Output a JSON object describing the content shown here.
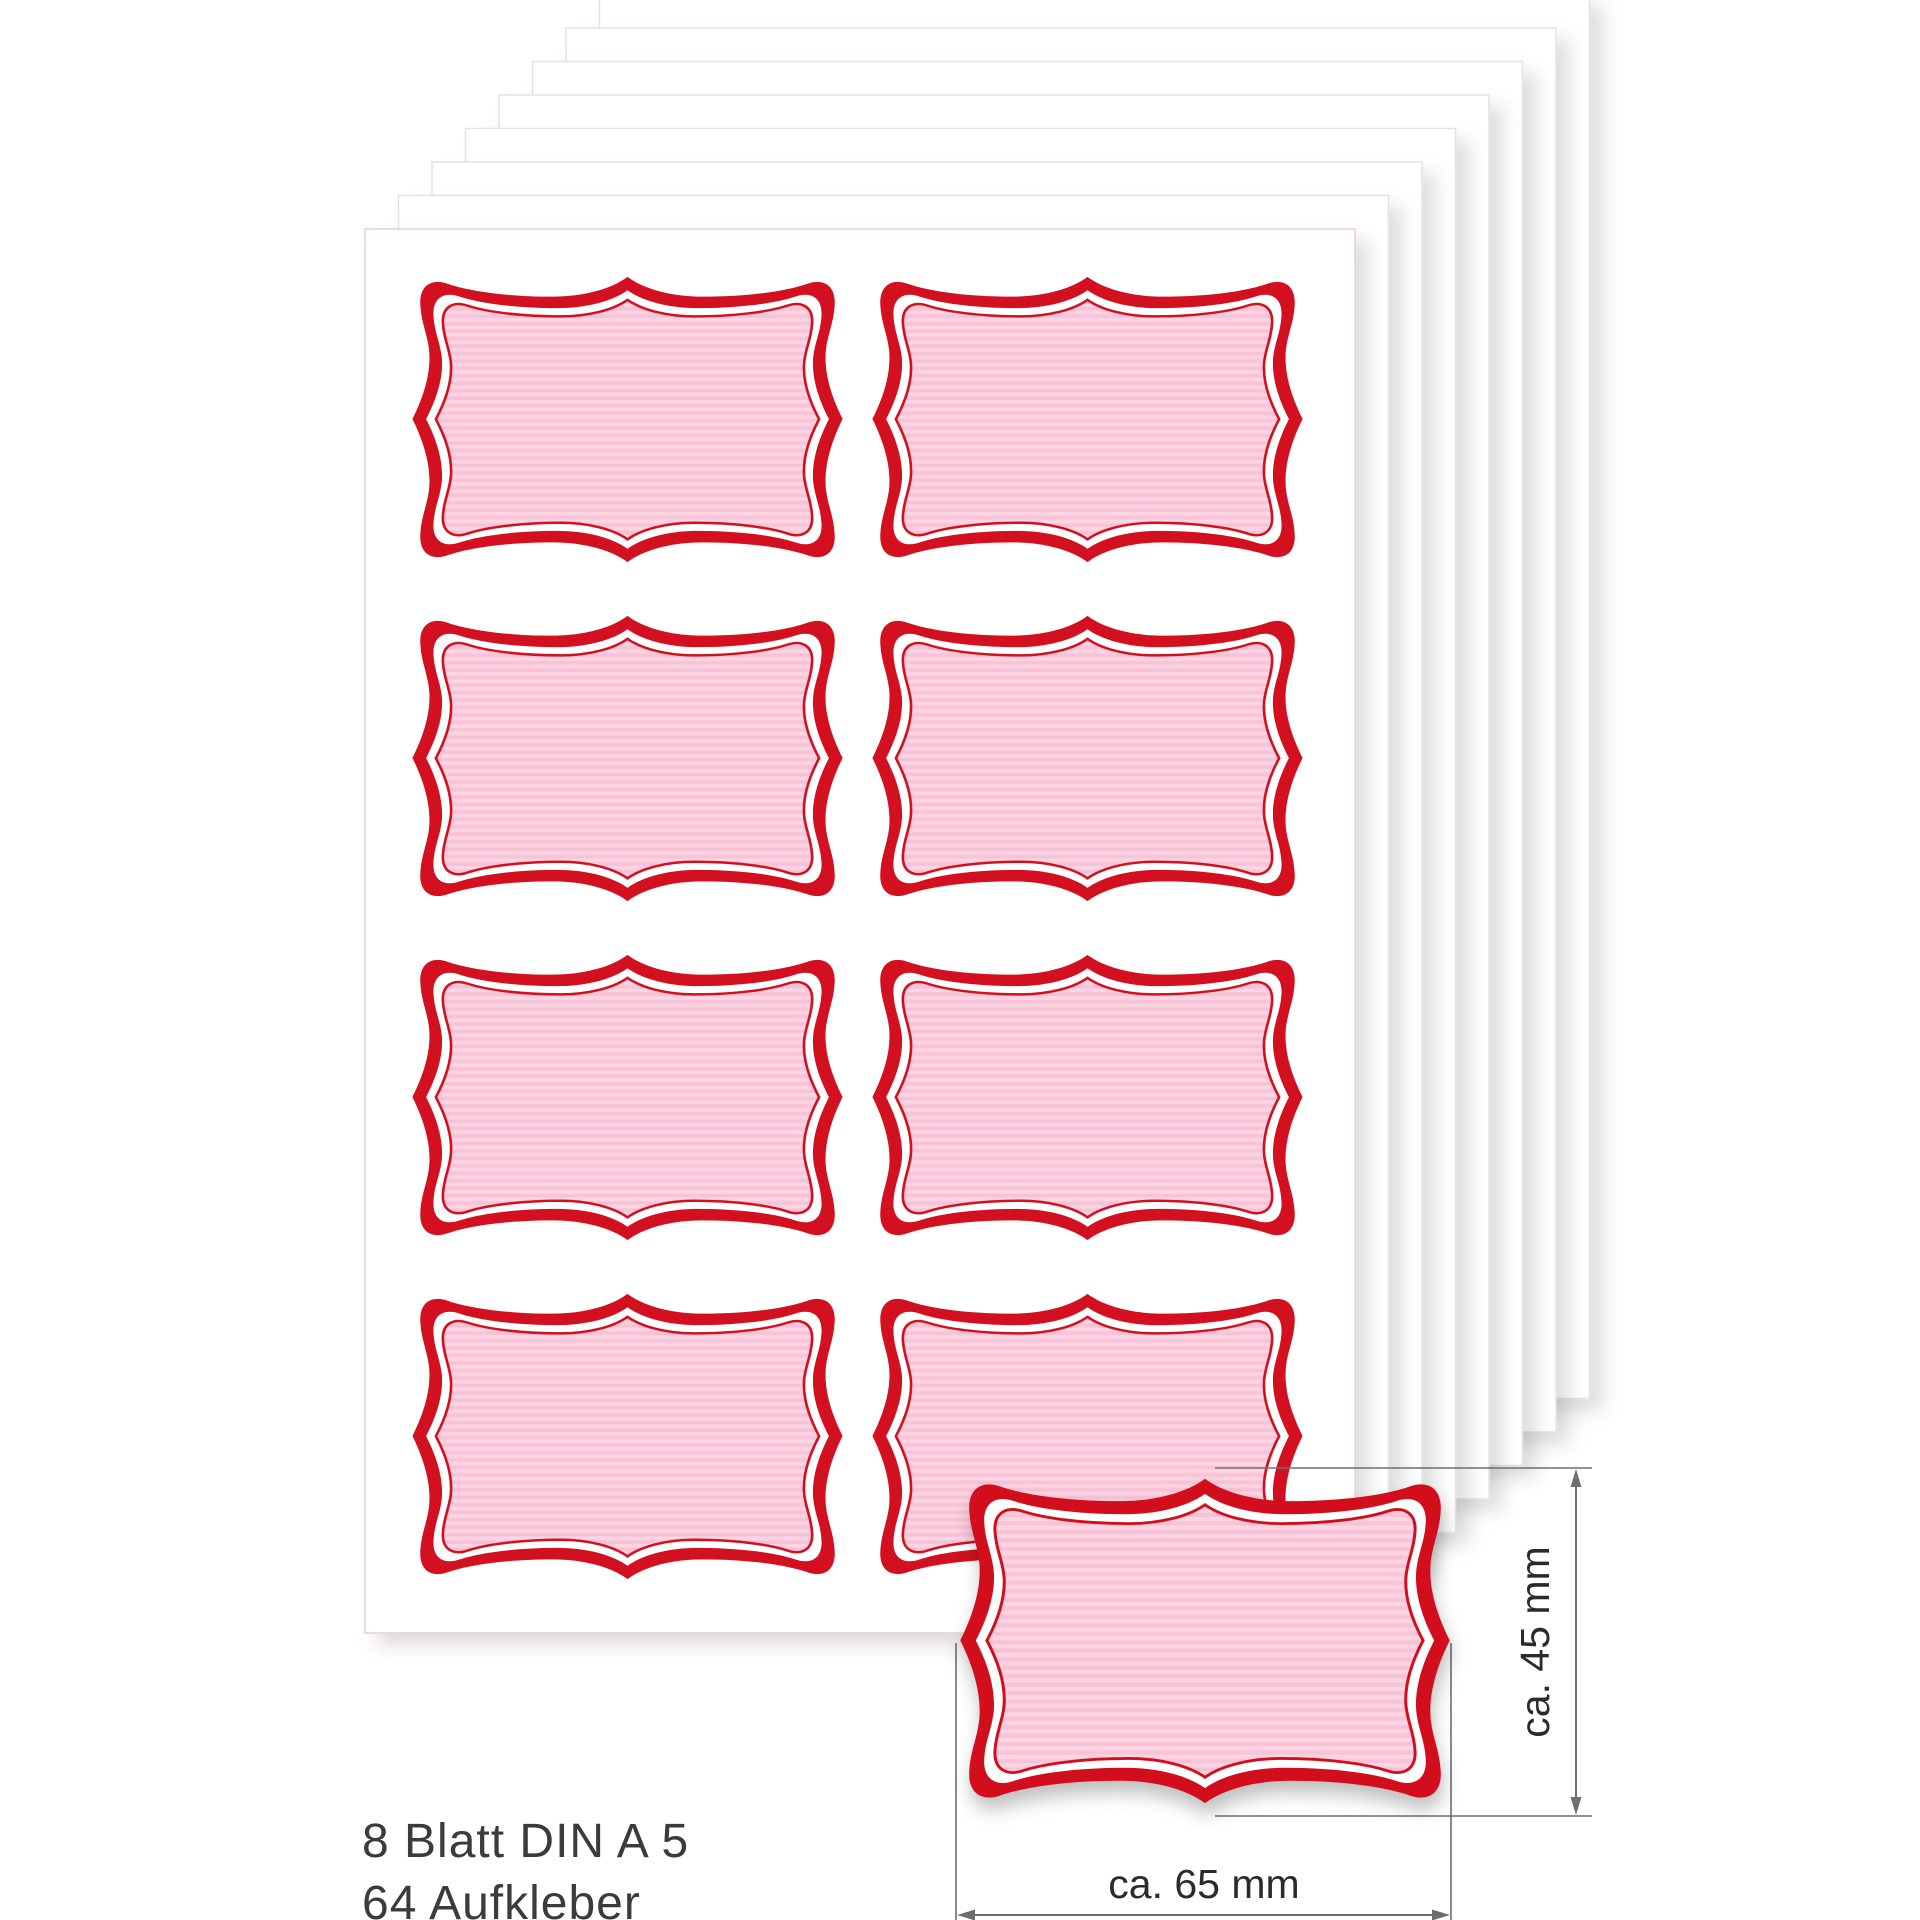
{
  "product": {
    "caption_line1": "8 Blatt DIN A 5",
    "caption_line2": "64 Aufkleber",
    "sheet_count": 8,
    "sticker_count": 64,
    "stickers_per_sheet": 8,
    "sheet_format": "DIN A 5",
    "grid": {
      "rows": 4,
      "columns": 2
    }
  },
  "dimension_callout": {
    "height_label": "ca. 45 mm",
    "width_label": "ca. 65 mm"
  },
  "colors": {
    "border_red": "#d2101f",
    "fill_pink": "#f9c3d7",
    "stripe_pink": "#fcd4e2",
    "sheet_white": "#ffffff",
    "sheet_edge": "#e3e3e3",
    "sheet_edge_front": "#e8cdd1",
    "dimension_line": "#6e6e6e",
    "dimension_text": "#2b2b2b",
    "caption_text": "#3b3b3b",
    "page_bg": "#ffffff"
  }
}
